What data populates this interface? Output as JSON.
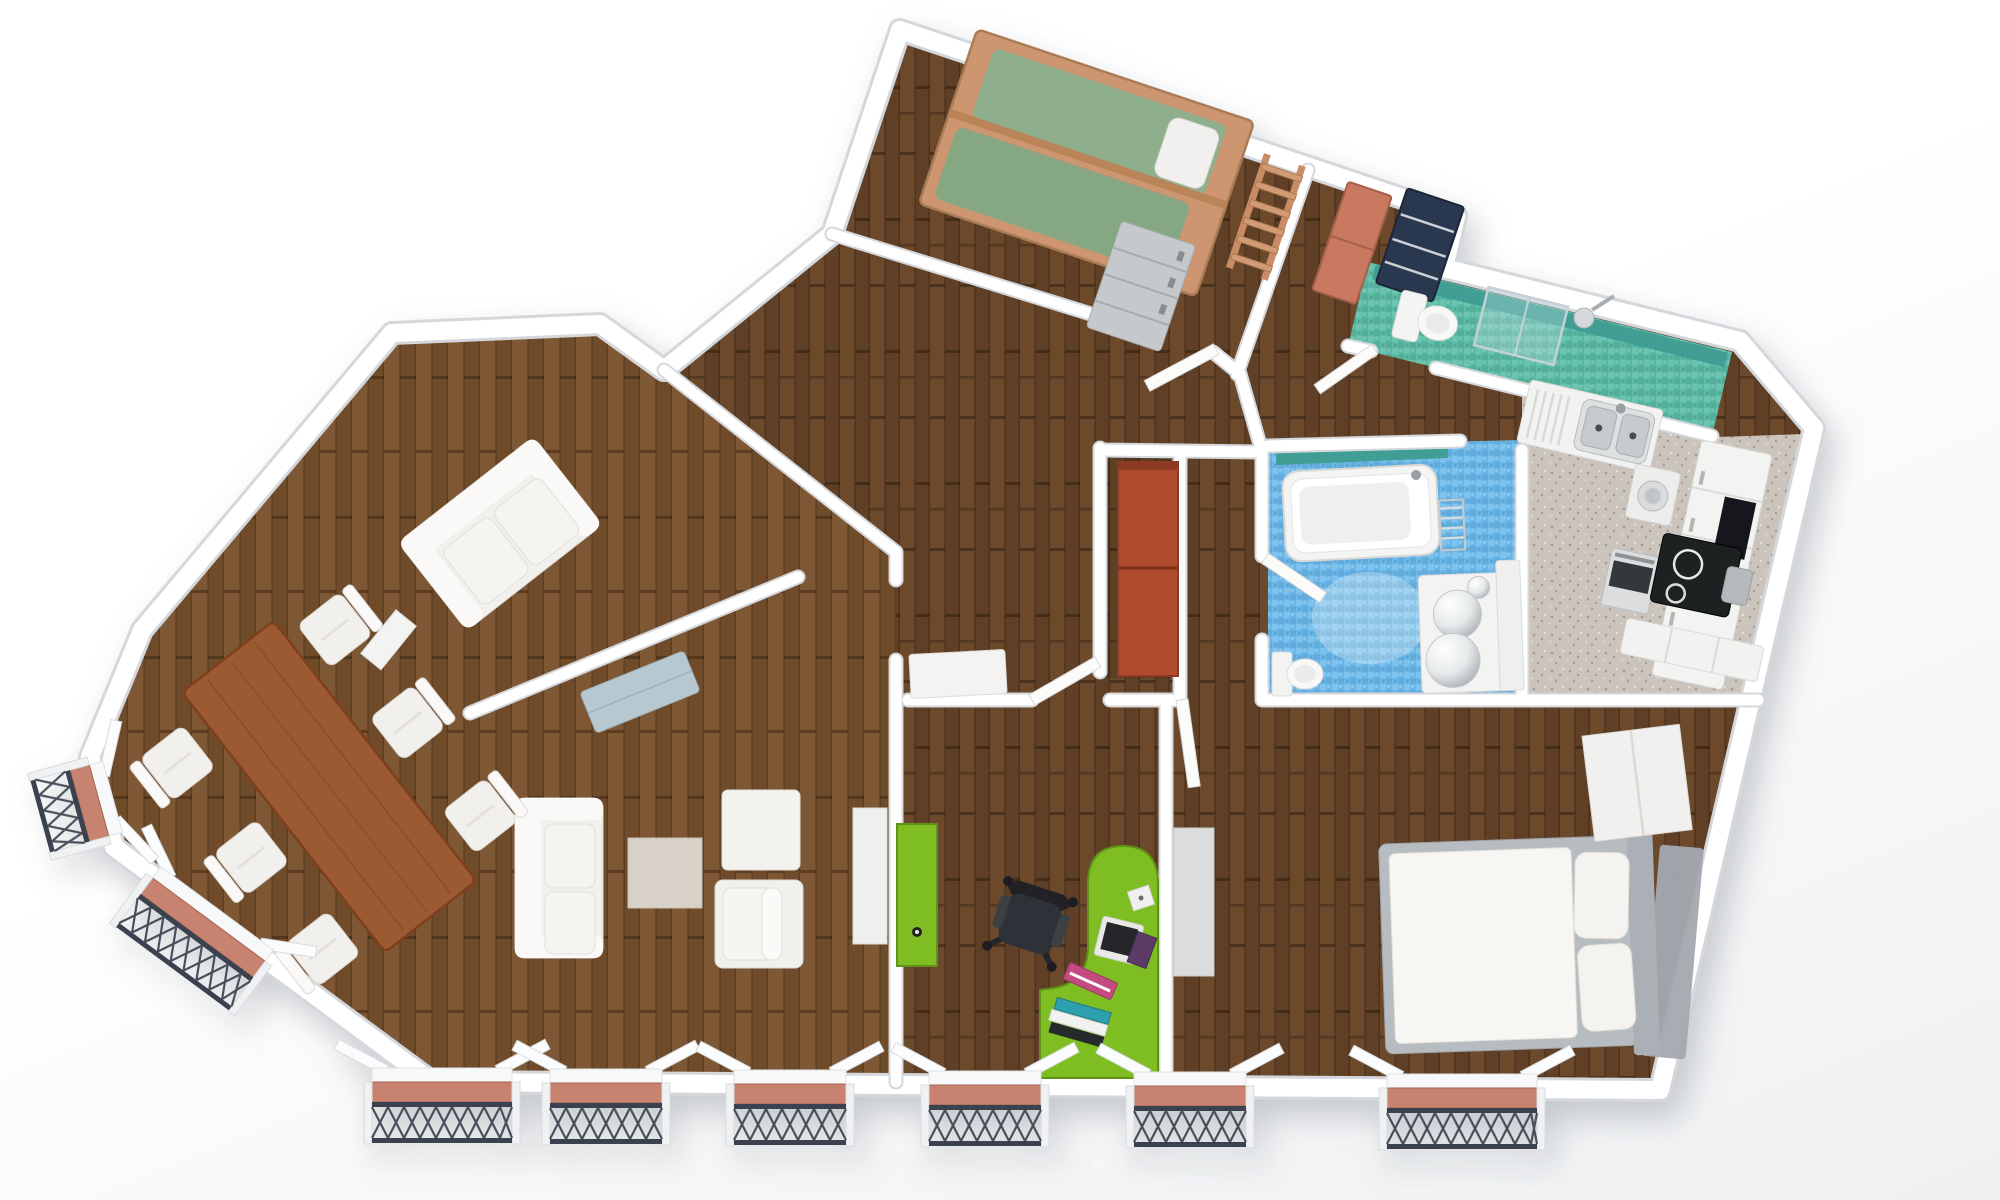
{
  "image": {
    "type": "3d-apartment-floor-plan-render",
    "view": "top-down",
    "background": "#FFFFFF"
  },
  "palette": {
    "wall": "#FFFFFF",
    "wall_edge": "#D4D7DB",
    "wood_dark_a": "#6C4A2C",
    "wood_dark_b": "#5E4025",
    "wood_light_a": "#7E5835",
    "wood_light_b": "#6F4C2B",
    "wood_seam": "#2A1A0C",
    "teal_floor": "#5ABBA5",
    "teal_wall": "#3F9E95",
    "blue_floor": "#69B6E8",
    "kitchen_floor": "#CBC4BD",
    "green": "#7FBE20",
    "green_dark": "#5E9212",
    "red_wardrobe": "#B04B2E",
    "salmon_cabinet": "#C8795F",
    "navy_cabinet": "#2C3850",
    "table_wood": "#9C5A32",
    "bed_wood": "#CE9571",
    "mattress_green": "#8FAF8C",
    "mattress_green2": "#85A782",
    "bed_frame": "#B7BCC1",
    "sofa": "#F2F0ED",
    "sofa_trim": "#DBD8D3",
    "beige_table": "#D8D1C7",
    "sideboard": "#B7C8D0",
    "balcony_floor": "#C8826F",
    "railing": "#3A434F",
    "chair_dark": "#2E3237",
    "book_pink": "#C44B82",
    "book_teal": "#2E9FAD",
    "book_purple": "#5C3B66",
    "white_goods": "#F2F2F1",
    "steel": "#C9CDCF",
    "black_cooktop": "#1E2022"
  },
  "apartment": {
    "rooms": [
      {
        "id": "kids-bedroom",
        "floor": "dark-wood",
        "furniture": [
          "bunk-bed",
          "bed-ladder",
          "pillow",
          "gray-dresser"
        ]
      },
      {
        "id": "entry-nook",
        "floor": "dark-wood",
        "furniture": [
          "salmon-cabinet",
          "navy-shelf"
        ]
      },
      {
        "id": "wc-shower-room",
        "floor": "teal-mosaic",
        "furniture": [
          "toilet",
          "glass-shower",
          "shower-head",
          "door-leaf"
        ]
      },
      {
        "id": "bathroom",
        "floor": "blue-mosaic",
        "furniture": [
          "bathtub",
          "towel-radiator",
          "double-sphere-vanity",
          "toilet",
          "door-leaf"
        ]
      },
      {
        "id": "kitchen",
        "floor": "speckled-stone",
        "furniture": [
          "double-sink-counter",
          "washing-machine",
          "oven",
          "black-cooktop",
          "tall-cabinet-row",
          "waste-bin",
          "base-cabinet"
        ]
      },
      {
        "id": "master-bedroom",
        "floor": "dark-wood",
        "furniture": [
          "double-bed",
          "pillow",
          "pillow",
          "headboard",
          "wardrobe",
          "gray-rug",
          "door-leaf"
        ]
      },
      {
        "id": "home-office",
        "floor": "dark-wood",
        "furniture": [
          "green-desk",
          "laptop",
          "book-stack",
          "book-stack",
          "office-chair",
          "green-wardrobe",
          "white-shelf",
          "door-leaf"
        ]
      },
      {
        "id": "hallway",
        "floor": "dark-wood",
        "furniture": [
          "red-wardrobe",
          "console-table"
        ]
      },
      {
        "id": "study",
        "floor": "light-wood",
        "furniture": [
          "loveseat",
          "wall-shelf"
        ]
      },
      {
        "id": "living-room",
        "floor": "light-wood",
        "furniture": [
          "sofa",
          "armchair",
          "ottoman",
          "coffee-table",
          "sideboard"
        ]
      },
      {
        "id": "dining-area",
        "floor": "light-wood",
        "furniture": [
          "wood-dining-table",
          "dining-chair",
          "dining-chair",
          "dining-chair",
          "dining-chair",
          "dining-chair",
          "dining-chair"
        ]
      }
    ],
    "exterior": {
      "balcony_count": 8,
      "railing_style": "dark-iron-lattice",
      "balcony_floor": "terracotta",
      "open_window_leaves": true
    }
  }
}
